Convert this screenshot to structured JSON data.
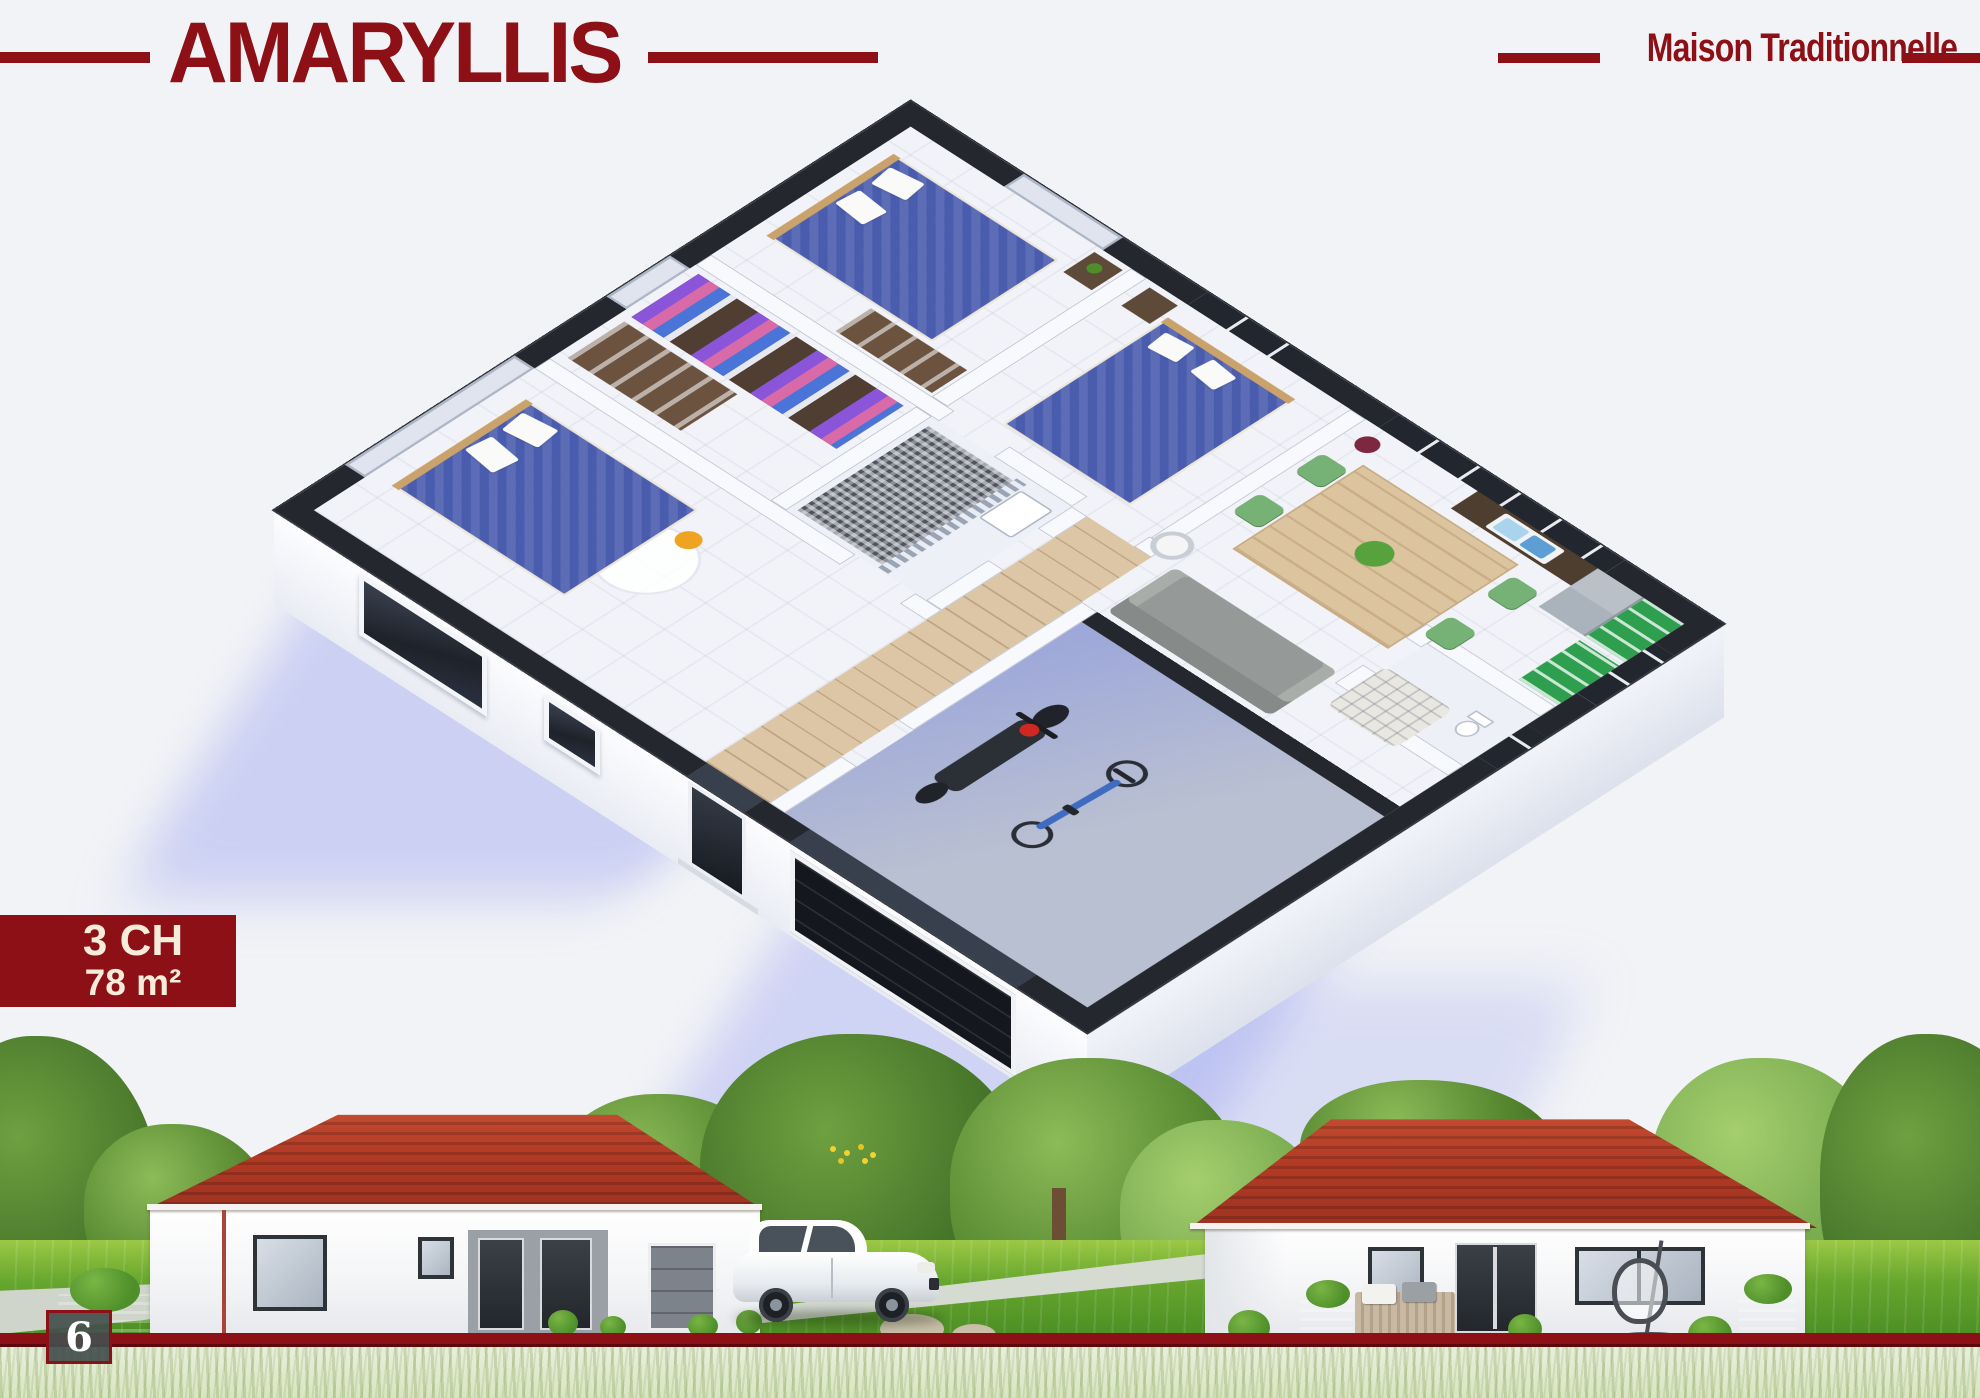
{
  "header": {
    "title": "AMARYLLIS",
    "tagline": "Maison Traditionnelle"
  },
  "badge": {
    "rooms": "3 CH",
    "area": "78 m²"
  },
  "footer": {
    "page_number": "6"
  },
  "colors": {
    "accent": "#8C1016",
    "accent_dark": "#5A090D",
    "cream": "#F5ECD9",
    "roof": "#B23A25",
    "roof_dark": "#8F2A19",
    "wall_top": "#24272E",
    "plan_floor": "#F2F3F8",
    "hall_wood": "#DCC6A6",
    "kitchen_green": "#2E9E4F",
    "bed_blue": "#4A5CAE",
    "garage_floor": "#B9C0D2",
    "shadow_blue": "#808CEE",
    "grass": "#66A62E",
    "grass_faded": "#D8E5C0",
    "tree_green": "#55862F",
    "driveway": "#D6DBD2",
    "background": "#F2F3F6"
  }
}
